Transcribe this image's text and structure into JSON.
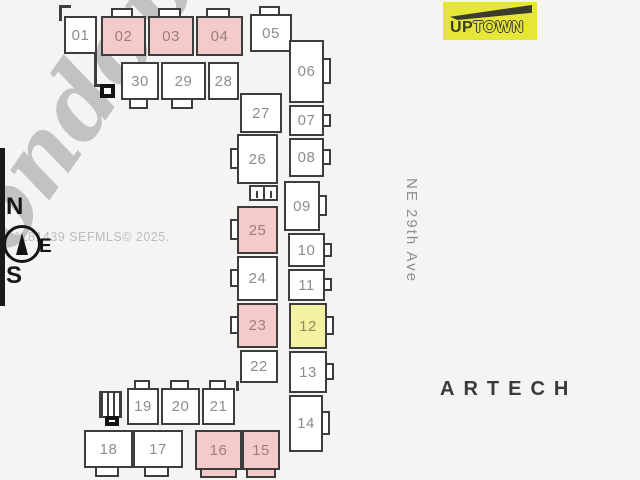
{
  "colors": {
    "bg": "#f6f4f2",
    "line": "#3d3d3d",
    "num": "#8d8d8d",
    "pink": "#f5caca",
    "yellow": "#f2f2a0",
    "logo_bg": "#e6e636",
    "logo_ink": "#3b3b2e",
    "watermark": "rgba(125,125,125,0.42)",
    "stamp": "#bdbdbd",
    "street": "#8f8f8f",
    "building": "#3a3a3a"
  },
  "watermark": {
    "text": "condoplan"
  },
  "logo": {
    "text_primary": "UP",
    "text_secondary": "TOWN"
  },
  "compass": {
    "north": "N",
    "east": "E",
    "south": "S"
  },
  "mls_stamp": {
    "text": "1181439 SEFMLS© 2025."
  },
  "street_label": {
    "text": "NE 29th Ave"
  },
  "building_label": {
    "text": "ARTECH"
  },
  "floorplan": {
    "highlight_pink_units": [
      "02",
      "03",
      "04",
      "25",
      "23",
      "16",
      "15"
    ],
    "highlight_yellow_units": [
      "12"
    ],
    "units": [
      {
        "n": "01",
        "x": 64,
        "y": 16,
        "w": 33,
        "h": 38,
        "f": "white",
        "tabs": []
      },
      {
        "n": "02",
        "x": 101,
        "y": 16,
        "w": 45,
        "h": 40,
        "f": "pink",
        "tabs": [
          "top"
        ]
      },
      {
        "n": "03",
        "x": 148,
        "y": 16,
        "w": 46,
        "h": 40,
        "f": "pink",
        "tabs": [
          "top"
        ]
      },
      {
        "n": "04",
        "x": 196,
        "y": 16,
        "w": 47,
        "h": 40,
        "f": "pink",
        "tabs": [
          "top"
        ]
      },
      {
        "n": "05",
        "x": 250,
        "y": 14,
        "w": 42,
        "h": 38,
        "f": "white",
        "tabs": [
          "top"
        ]
      },
      {
        "n": "30",
        "x": 121,
        "y": 62,
        "w": 38,
        "h": 38,
        "f": "white",
        "tabs": [
          "bottom"
        ]
      },
      {
        "n": "29",
        "x": 161,
        "y": 62,
        "w": 45,
        "h": 38,
        "f": "white",
        "tabs": [
          "bottom"
        ]
      },
      {
        "n": "28",
        "x": 208,
        "y": 62,
        "w": 31,
        "h": 38,
        "f": "white",
        "tabs": []
      },
      {
        "n": "27",
        "x": 240,
        "y": 93,
        "w": 42,
        "h": 40,
        "f": "white",
        "tabs": []
      },
      {
        "n": "26",
        "x": 237,
        "y": 134,
        "w": 41,
        "h": 50,
        "f": "white",
        "tabs": [
          "left"
        ]
      },
      {
        "n": "25",
        "x": 237,
        "y": 206,
        "w": 41,
        "h": 48,
        "f": "pink",
        "tabs": [
          "left"
        ]
      },
      {
        "n": "24",
        "x": 237,
        "y": 256,
        "w": 41,
        "h": 45,
        "f": "white",
        "tabs": [
          "left"
        ]
      },
      {
        "n": "23",
        "x": 237,
        "y": 303,
        "w": 41,
        "h": 45,
        "f": "pink",
        "tabs": [
          "left"
        ]
      },
      {
        "n": "22",
        "x": 240,
        "y": 350,
        "w": 38,
        "h": 33,
        "f": "white",
        "tabs": []
      },
      {
        "n": "06",
        "x": 289,
        "y": 40,
        "w": 35,
        "h": 63,
        "f": "white",
        "tabs": [
          "right"
        ]
      },
      {
        "n": "07",
        "x": 289,
        "y": 105,
        "w": 35,
        "h": 31,
        "f": "white",
        "tabs": [
          "right"
        ]
      },
      {
        "n": "08",
        "x": 289,
        "y": 138,
        "w": 35,
        "h": 39,
        "f": "white",
        "tabs": [
          "right"
        ]
      },
      {
        "n": "09",
        "x": 284,
        "y": 181,
        "w": 36,
        "h": 50,
        "f": "white",
        "tabs": [
          "right"
        ]
      },
      {
        "n": "10",
        "x": 288,
        "y": 233,
        "w": 37,
        "h": 34,
        "f": "white",
        "tabs": [
          "right"
        ]
      },
      {
        "n": "11",
        "x": 288,
        "y": 269,
        "w": 37,
        "h": 32,
        "f": "white",
        "tabs": [
          "right"
        ]
      },
      {
        "n": "12",
        "x": 289,
        "y": 303,
        "w": 38,
        "h": 46,
        "f": "yellow",
        "tabs": [
          "right"
        ]
      },
      {
        "n": "13",
        "x": 289,
        "y": 351,
        "w": 38,
        "h": 42,
        "f": "white",
        "tabs": [
          "right"
        ]
      },
      {
        "n": "14",
        "x": 289,
        "y": 395,
        "w": 34,
        "h": 57,
        "f": "white",
        "tabs": [
          "right"
        ]
      },
      {
        "n": "19",
        "x": 127,
        "y": 388,
        "w": 32,
        "h": 37,
        "f": "white",
        "tabs": [
          "top"
        ]
      },
      {
        "n": "20",
        "x": 161,
        "y": 388,
        "w": 39,
        "h": 37,
        "f": "white",
        "tabs": [
          "top"
        ]
      },
      {
        "n": "21",
        "x": 202,
        "y": 388,
        "w": 33,
        "h": 37,
        "f": "white",
        "tabs": [
          "top"
        ]
      },
      {
        "n": "18",
        "x": 84,
        "y": 430,
        "w": 49,
        "h": 38,
        "f": "white",
        "tabs": [
          "bottom"
        ]
      },
      {
        "n": "17",
        "x": 133,
        "y": 430,
        "w": 50,
        "h": 38,
        "f": "white",
        "tabs": [
          "bottom"
        ]
      },
      {
        "n": "16",
        "x": 195,
        "y": 430,
        "w": 47,
        "h": 40,
        "f": "pink",
        "tabs": [
          "bottom-wide"
        ]
      },
      {
        "n": "15",
        "x": 242,
        "y": 430,
        "w": 38,
        "h": 40,
        "f": "pink",
        "tabs": [
          "bottom-wide"
        ]
      }
    ],
    "features": [
      {
        "type": "wall",
        "x": 59,
        "y": 5,
        "w": 3,
        "h": 16
      },
      {
        "type": "wall",
        "x": 59,
        "y": 5,
        "w": 12,
        "h": 3
      },
      {
        "type": "wall",
        "x": 94,
        "y": 52,
        "w": 3,
        "h": 35
      },
      {
        "type": "wall",
        "x": 96,
        "y": 84,
        "w": 8,
        "h": 3
      },
      {
        "type": "square",
        "x": 100,
        "y": 84,
        "w": 15,
        "h": 14
      },
      {
        "type": "elevator",
        "x": 249,
        "y": 185,
        "w": 27,
        "h": 16
      },
      {
        "type": "wall",
        "x": 236,
        "y": 381,
        "w": 3,
        "h": 10
      },
      {
        "type": "stairs",
        "x": 99,
        "y": 391,
        "w": 23,
        "h": 27
      },
      {
        "type": "square",
        "x": 105,
        "y": 416,
        "w": 14,
        "h": 10
      }
    ]
  }
}
